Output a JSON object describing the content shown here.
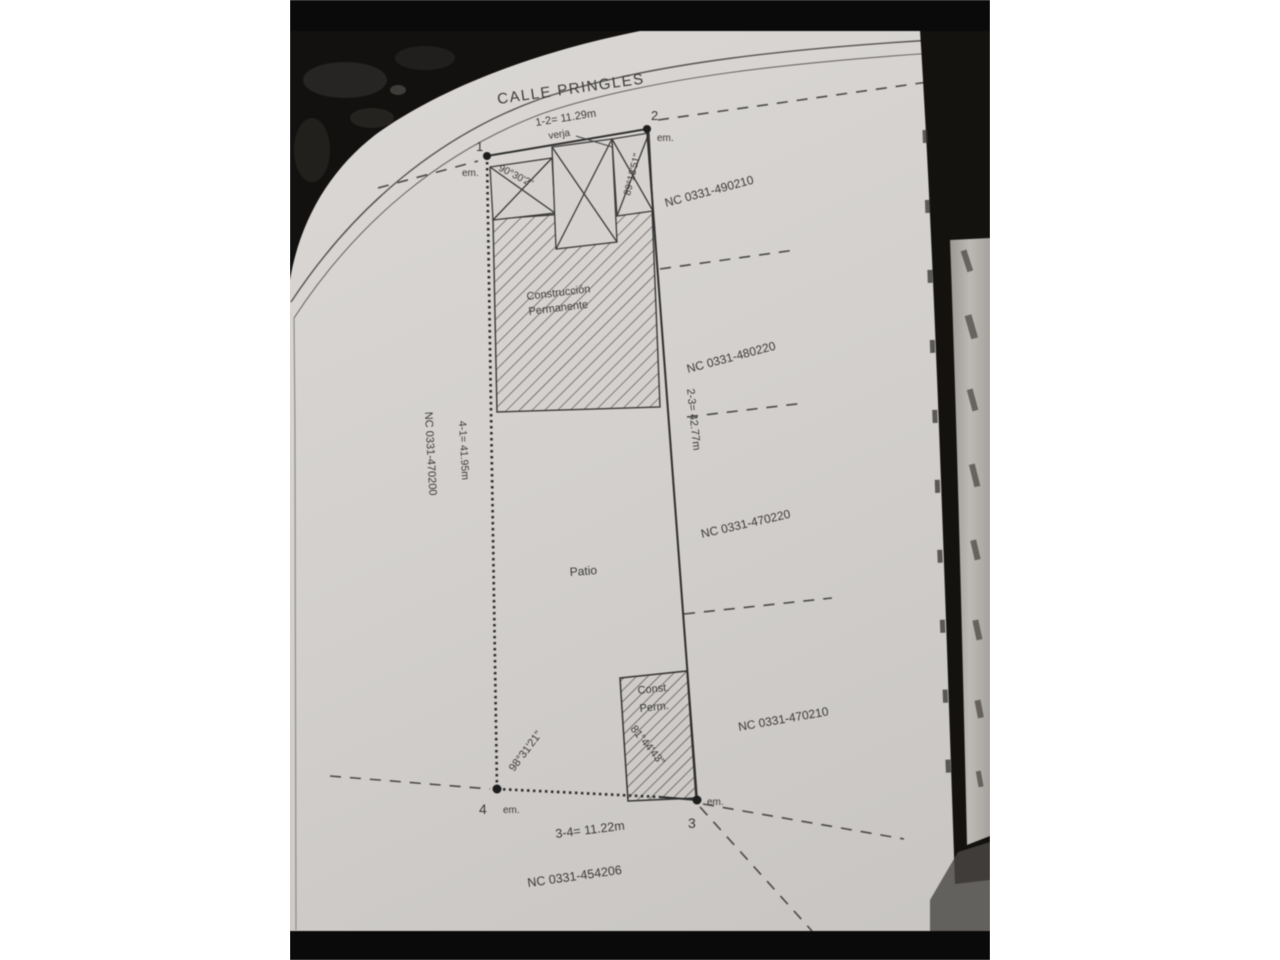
{
  "plan": {
    "street": "CALLE PRINGLES",
    "fence": "verja",
    "dim_top": "1-2= 11.29m",
    "dim_right": "2-3= 42.77m",
    "dim_bottom": "3-4= 11.22m",
    "dim_left": "4-1= 41.95m",
    "angle_corner_1": "90°30'2\"",
    "angle_corner_2": "89°13'51\"",
    "angle_corner_3": "81°44'43\"",
    "angle_corner_4": "98°31'21\"",
    "area_construction_1": "Construcción",
    "area_construction_2": "Permanente",
    "area_patio": "Patio",
    "area_const_small_1": "Const.",
    "area_const_small_2": "Perm.",
    "nc_left": "NC 0331-470200",
    "nc_right_top": "NC 0331-490210",
    "nc_right_2": "NC 0331-480220",
    "nc_right_3": "NC 0331-470220",
    "nc_right_4": "NC 0331-470210",
    "nc_bottom": "NC 0331-454206",
    "corners": [
      {
        "id": "1",
        "marker": "em."
      },
      {
        "id": "2",
        "marker": "em."
      },
      {
        "id": "3",
        "marker": "em."
      },
      {
        "id": "4",
        "marker": "em."
      }
    ]
  },
  "colors": {
    "paper": "#d3d0cd",
    "ink": "#3a3a3a",
    "photo_background": "#121110",
    "page_margin_line": "#55534f",
    "rolled_page": "#b3b0ac"
  }
}
